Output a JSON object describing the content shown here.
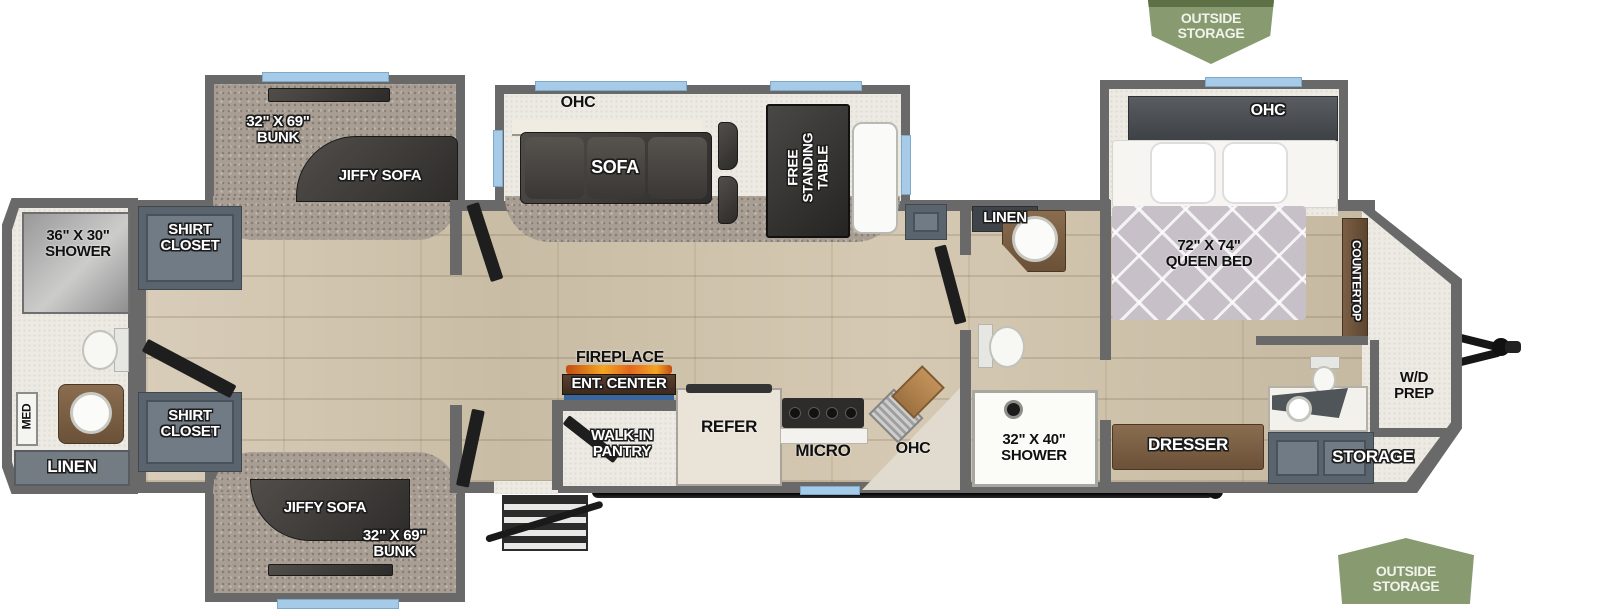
{
  "badges": {
    "top": "OUTSIDE\nSTORAGE",
    "bottom": "OUTSIDE\nSTORAGE"
  },
  "rear_bath": {
    "shower": "36\" X 30\"\nSHOWER",
    "med": "MED",
    "linen": "LINEN"
  },
  "closets": {
    "top": "SHIRT\nCLOSET",
    "bottom": "SHIRT\nCLOSET"
  },
  "bunks": {
    "top_bunk": "32\" X 69\"\nBUNK",
    "top_sofa": "JIFFY SOFA",
    "bottom_sofa": "JIFFY SOFA",
    "bottom_bunk": "32\" X 69\"\nBUNK"
  },
  "living": {
    "ohc": "OHC",
    "sofa": "SOFA",
    "table": "FREE\nSTANDING\nTABLE"
  },
  "kitchen": {
    "fireplace": "FIREPLACE",
    "ent_center": "ENT. CENTER",
    "pantry": "WALK-IN\nPANTRY",
    "refer": "REFER",
    "micro": "MICRO",
    "ohc": "OHC"
  },
  "mid_bath": {
    "linen": "LINEN",
    "shower": "32\" X 40\"\nSHOWER"
  },
  "bedroom": {
    "ohc": "OHC",
    "bed": "72\" X 74\"\nQUEEN BED",
    "countertop": "COUNTERTOP",
    "dresser": "DRESSER"
  },
  "front": {
    "wd_prep": "W/D\nPREP",
    "storage": "STORAGE"
  },
  "colors": {
    "wall": "#696969",
    "wood_floor": "#cfc3ad",
    "carpet": "#a89e93",
    "light_floor": "#edeae3",
    "cabinet": "#5a646e",
    "dark_furniture": "#3c3a38",
    "wood_furniture": "#7b5f45",
    "window_blue": "#a6cbe8",
    "badge_green": "#879a70",
    "flame_orange": "#e2661f",
    "flame_blue": "#3a66a0",
    "bed_quilt": "#c8c0c8"
  }
}
